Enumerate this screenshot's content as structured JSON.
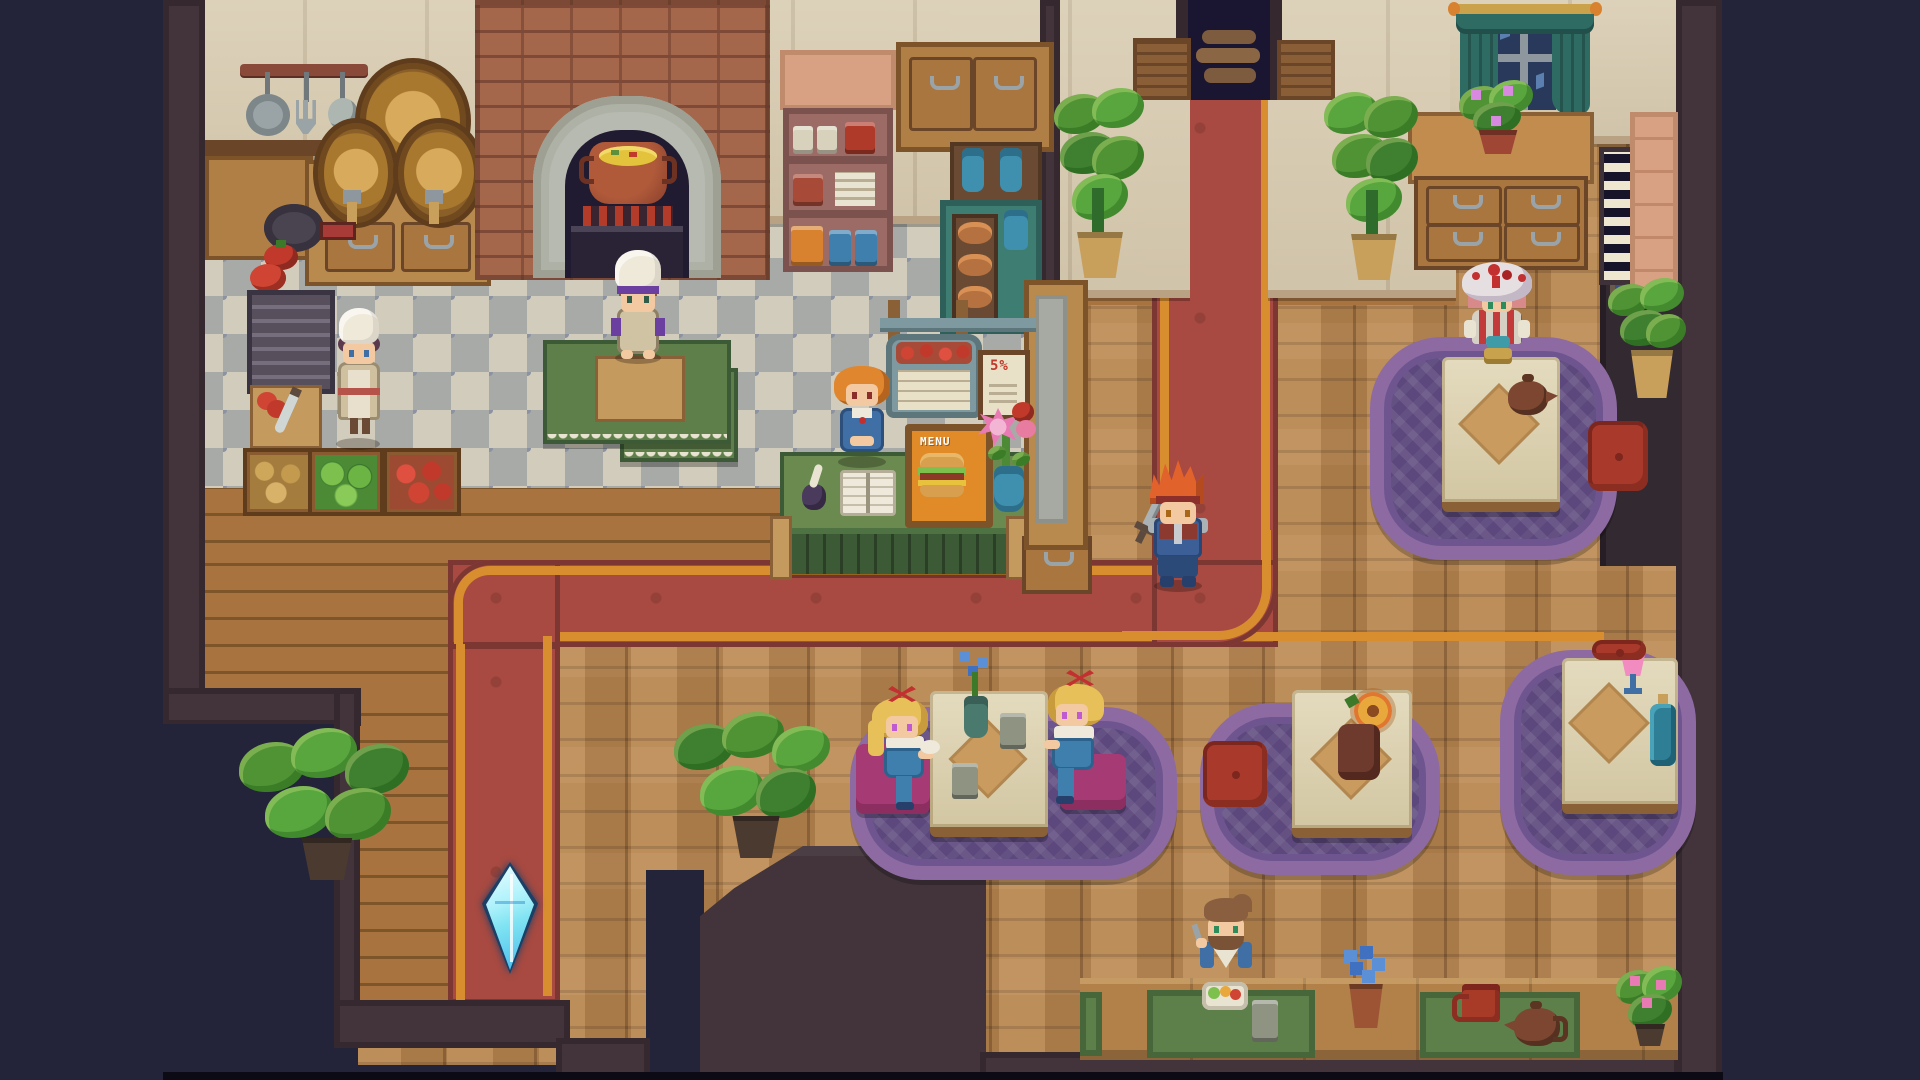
{
  "scene": {
    "title": "Pixel-art tavern restaurant interior",
    "view": "top-down 2D game scene, no HUD visible"
  },
  "palette": {
    "outside_navy": "#232339",
    "wall_dark_brown": "#42343a",
    "wall_cream": "#d8cbb0",
    "brick": "#a5674c",
    "stone_arch_gray": "#b7bab0",
    "checker_light": "#d2ccbc",
    "checker_gray": "#a7aaa6",
    "plank_wood": "#a26d3c",
    "parquet_wood": "#b5834e",
    "carpet_red": "#a84a41",
    "carpet_gold_stripe": "#d88e2e",
    "rug_purple": "#8d6ba2",
    "rug_inner_purple": "#5c487c",
    "table_cream": "#dbcfa9",
    "bench_magenta": "#a63a74",
    "cushion_red": "#a8392b",
    "counter_green": "#5e7f49",
    "leaf_green": "#4f9335",
    "crystal_cyan": "#7fe3f2",
    "cauldron_copper": "#a14a31",
    "soup_yellow": "#e3c23c"
  },
  "signs": {
    "discount_poster": "5%",
    "menu_board": "MENU"
  },
  "characters": [
    {
      "id": "chef-man",
      "desc": "chef in white toque with purple band at green prep table by the oven"
    },
    {
      "id": "chef-woman",
      "desc": "cook in white toque and cream apron on checkered kitchen floor"
    },
    {
      "id": "hostess",
      "desc": "orange-haired hostess in blue dress behind reception counter with guest book"
    },
    {
      "id": "player-knight",
      "desc": "spiky orange-haired adventurer in blue armor with sword standing on red carpet"
    },
    {
      "id": "lady-red-hat",
      "desc": "guest in white hat with red flowers seated at tea table"
    },
    {
      "id": "twin-girl-left",
      "desc": "blonde girl with red bow on magenta bench"
    },
    {
      "id": "twin-girl-right",
      "desc": "blonde girl with red bow facing her twin"
    },
    {
      "id": "bearded-diner",
      "desc": "brown-haired bearded man eating salad at the low bar"
    }
  ],
  "props": [
    "wine-barrels",
    "hanging-utensils",
    "frying-pan",
    "tomatoes",
    "metal-grate",
    "cutting-board",
    "potato-crate",
    "cabbage-crate",
    "tomato-crate",
    "brick-oven",
    "copper-cauldron",
    "mauve-dish-shelf",
    "oak-cabinet",
    "teal-hutch",
    "bread-rack",
    "hanging-menu-sign",
    "discount-poster",
    "burger-menu-board",
    "flower-vase",
    "guest-book",
    "ink-quill",
    "reception-counter",
    "wood-pillar",
    "save-crystal",
    "doorway-steps",
    "curtained-window",
    "drawer-desk",
    "piano-keys-decor",
    "potted-plants",
    "tea-table",
    "teapots",
    "mugs",
    "pink-drink",
    "blue-bottle",
    "red-cushions",
    "purple-rugs",
    "low-dining-bar",
    "green-mats",
    "salad-plate"
  ]
}
